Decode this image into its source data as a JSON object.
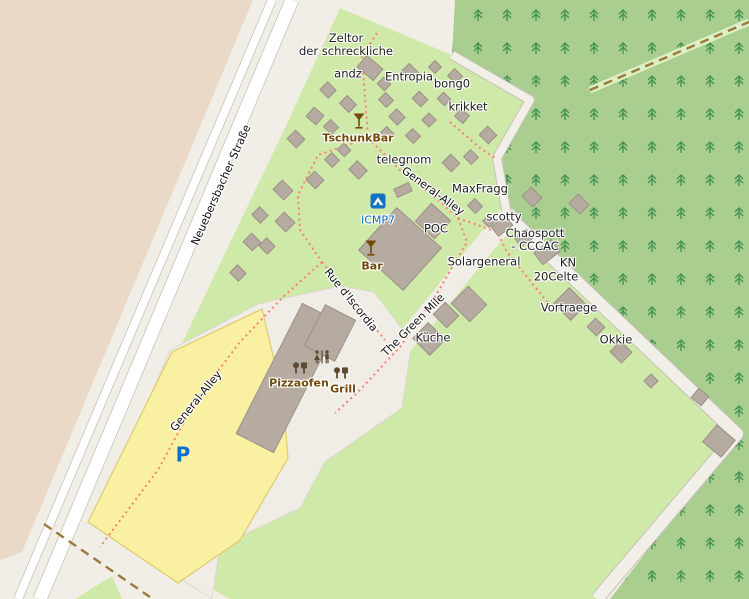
{
  "map": {
    "colors": {
      "bg": "#f1eee8",
      "tan": "#e9d9c6",
      "green": "#cfe9a8",
      "forest": "#aace8f",
      "tree": "#449552",
      "road_fill": "#ffffff",
      "road_casing": "#c6c2ba",
      "offwhite_road": "#f2efe9",
      "corridor": "#f0ede7",
      "corridor_stroke": "#dcd8d0",
      "yellow": "#faf0a2",
      "yellow_border": "#ddcb6e",
      "building": "#b5aba1",
      "building_stroke": "#9b9187",
      "path_dots": "#fa8072",
      "track": "#9c7a3a",
      "track_halo": "#dcefc5",
      "amenity_brown": "#734a08",
      "poi_icon_brown": "#5f4a33",
      "campsite_blue": "#1272bf",
      "parking_blue": "#0d6fd0"
    },
    "regions": {
      "tan": "0,0 253,0 22,552 0,560",
      "green_main": "340,8 452,55 530,100 497,158 507,215 737,434 597,599 230,599 95,525 285,128",
      "forest": "455,0 749,0 749,599 610,599 737,434 507,215 497,158 530,100 452,55",
      "corridor": "258,304 340,286 374,292 412,342 402,408 325,462 300,508 220,546 212,599 95,525 170,350",
      "yellow_parking": "262,309 283,398 288,458 240,540 178,583 88,522 172,352",
      "green_patch": "75,599 112,576 122,599"
    },
    "roads": {
      "greenmile_band": {
        "pts": [
          [
            507,
            218
          ],
          [
            470,
            262
          ],
          [
            425,
            318
          ],
          [
            378,
            372
          ],
          [
            340,
            412
          ]
        ],
        "w": 21
      },
      "forest_path": {
        "pts": [
          [
            452,
            55
          ],
          [
            530,
            100
          ],
          [
            497,
            158
          ],
          [
            507,
            215
          ]
        ],
        "w": 8
      },
      "forest_road": {
        "pts": [
          [
            507,
            215
          ],
          [
            737,
            434
          ],
          [
            597,
            599
          ]
        ],
        "w": 12
      },
      "main_road_small": {
        "pts": [
          [
            272,
            0
          ],
          [
            18,
            599
          ]
        ],
        "w": 8
      },
      "main_road_big": {
        "pts": [
          [
            292,
            0
          ],
          [
            40,
            599
          ]
        ],
        "w": 13
      }
    },
    "tracks": [
      {
        "pts": [
          [
            590,
            90
          ],
          [
            749,
            22
          ]
        ],
        "halo": true
      },
      {
        "pts": [
          [
            44,
            524
          ],
          [
            150,
            597
          ]
        ],
        "halo": false
      }
    ],
    "paths_dotted": [
      [
        [
          377,
          33
        ],
        [
          366,
          50
        ],
        [
          362,
          58
        ],
        [
          368,
          136
        ]
      ],
      [
        [
          368,
          138
        ],
        [
          318,
          155
        ],
        [
          298,
          195
        ],
        [
          300,
          230
        ],
        [
          322,
          262
        ]
      ],
      [
        [
          368,
          138
        ],
        [
          400,
          170
        ],
        [
          433,
          196
        ],
        [
          458,
          218
        ]
      ],
      [
        [
          458,
          218
        ],
        [
          497,
          232
        ],
        [
          507,
          252
        ],
        [
          548,
          303
        ]
      ],
      [
        [
          458,
          218
        ],
        [
          467,
          242
        ],
        [
          435,
          297
        ],
        [
          400,
          347
        ],
        [
          358,
          392
        ],
        [
          335,
          413
        ]
      ],
      [
        [
          322,
          262
        ],
        [
          352,
          300
        ],
        [
          385,
          340
        ]
      ],
      [
        [
          322,
          262
        ],
        [
          283,
          297
        ],
        [
          240,
          342
        ],
        [
          196,
          400
        ],
        [
          158,
          470
        ],
        [
          100,
          547
        ]
      ],
      [
        [
          450,
          122
        ],
        [
          480,
          148
        ],
        [
          495,
          158
        ]
      ]
    ],
    "buildings": [
      [
        370,
        68,
        21,
        15,
        40
      ],
      [
        328,
        90,
        12,
        11,
        45
      ],
      [
        348,
        104,
        13,
        11,
        45
      ],
      [
        315,
        116,
        13,
        12,
        40
      ],
      [
        331,
        127,
        11,
        10,
        45
      ],
      [
        296,
        139,
        13,
        12,
        45
      ],
      [
        384,
        84,
        10,
        9,
        45
      ],
      [
        410,
        72,
        13,
        11,
        45
      ],
      [
        435,
        67,
        9,
        9,
        45
      ],
      [
        455,
        76,
        11,
        10,
        45
      ],
      [
        386,
        100,
        11,
        10,
        45
      ],
      [
        420,
        99,
        12,
        10,
        45
      ],
      [
        444,
        99,
        10,
        9,
        45
      ],
      [
        397,
        117,
        12,
        11,
        45
      ],
      [
        429,
        120,
        10,
        10,
        45
      ],
      [
        462,
        116,
        11,
        10,
        40
      ],
      [
        387,
        134,
        11,
        10,
        45
      ],
      [
        413,
        136,
        11,
        10,
        45
      ],
      [
        488,
        135,
        13,
        12,
        45
      ],
      [
        344,
        150,
        10,
        9,
        45
      ],
      [
        332,
        160,
        11,
        10,
        45
      ],
      [
        358,
        170,
        14,
        12,
        45
      ],
      [
        283,
        190,
        15,
        13,
        45
      ],
      [
        315,
        180,
        13,
        12,
        45
      ],
      [
        260,
        215,
        12,
        11,
        45
      ],
      [
        285,
        222,
        15,
        13,
        45
      ],
      [
        252,
        242,
        13,
        12,
        45
      ],
      [
        267,
        246,
        12,
        11,
        45
      ],
      [
        238,
        273,
        12,
        11,
        45
      ],
      [
        451,
        163,
        13,
        12,
        45
      ],
      [
        471,
        157,
        11,
        10,
        45
      ],
      [
        403,
        190,
        16,
        9,
        -25
      ],
      [
        475,
        206,
        11,
        10,
        45
      ],
      [
        489,
        221,
        9,
        9,
        45
      ],
      [
        532,
        197,
        15,
        13,
        45
      ],
      [
        579,
        204,
        15,
        13,
        45
      ],
      [
        502,
        226,
        18,
        12,
        -38
      ],
      [
        524,
        238,
        15,
        11,
        -38
      ],
      [
        547,
        252,
        22,
        15,
        -38
      ],
      [
        400,
        249,
        60,
        57,
        42
      ],
      [
        433,
        221,
        26,
        24,
        42
      ],
      [
        469,
        304,
        26,
        24,
        45
      ],
      [
        446,
        315,
        19,
        17,
        45
      ],
      [
        429,
        339,
        24,
        22,
        45
      ],
      [
        570,
        304,
        24,
        22,
        45
      ],
      [
        596,
        327,
        13,
        12,
        45
      ],
      [
        621,
        352,
        16,
        15,
        45
      ],
      [
        651,
        381,
        10,
        10,
        45
      ],
      [
        700,
        397,
        13,
        12,
        40
      ],
      [
        719,
        441,
        24,
        22,
        40
      ],
      [
        288,
        378,
        42,
        146,
        27
      ],
      [
        330,
        333,
        34,
        46,
        27
      ]
    ],
    "street_labels": [
      {
        "text": "Neuebersbacher Straße",
        "x": 221,
        "y": 185,
        "rot": -66
      },
      {
        "text": "General-Alley",
        "x": 433,
        "y": 191,
        "rot": 36
      },
      {
        "text": "General-Alley",
        "x": 196,
        "y": 401,
        "rot": -51
      },
      {
        "text": "Rue d'Iscordia",
        "x": 351,
        "y": 300,
        "rot": 51
      },
      {
        "text": "The Green Mile",
        "x": 413,
        "y": 325,
        "rot": -45
      }
    ],
    "poi_labels": [
      {
        "text": "Zeltor\nder schreckliche",
        "x": 346,
        "y": 45,
        "type": "place"
      },
      {
        "text": "andz",
        "x": 348,
        "y": 74,
        "type": "place"
      },
      {
        "text": "Entropia",
        "x": 409,
        "y": 77,
        "type": "place"
      },
      {
        "text": "bong0",
        "x": 452,
        "y": 84,
        "type": "place"
      },
      {
        "text": "krikket",
        "x": 468,
        "y": 107,
        "type": "place"
      },
      {
        "text": "telegnom",
        "x": 404,
        "y": 160,
        "type": "place"
      },
      {
        "text": "MaxFragg",
        "x": 480,
        "y": 189,
        "type": "place"
      },
      {
        "text": "scotty",
        "x": 504,
        "y": 217,
        "type": "place"
      },
      {
        "text": "POC",
        "x": 436,
        "y": 229,
        "type": "place"
      },
      {
        "text": "Chaospott\n- CCCAC",
        "x": 535,
        "y": 240,
        "type": "place"
      },
      {
        "text": "Solargeneral",
        "x": 484,
        "y": 262,
        "type": "place"
      },
      {
        "text": "KN",
        "x": 568,
        "y": 263,
        "type": "place"
      },
      {
        "text": "20Celte",
        "x": 556,
        "y": 277,
        "type": "place"
      },
      {
        "text": "Vortraege",
        "x": 569,
        "y": 308,
        "type": "place"
      },
      {
        "text": "Okkie",
        "x": 616,
        "y": 340,
        "type": "place"
      },
      {
        "text": "Küche",
        "x": 433,
        "y": 338,
        "type": "place"
      },
      {
        "text": "TschunkBar",
        "x": 358,
        "y": 138,
        "type": "amenity"
      },
      {
        "text": "Bar",
        "x": 372,
        "y": 266,
        "type": "amenity"
      },
      {
        "text": "Pizzaofen",
        "x": 299,
        "y": 383,
        "type": "amenity"
      },
      {
        "text": "Grill",
        "x": 343,
        "y": 389,
        "type": "amenity"
      },
      {
        "text": "ICMP7",
        "x": 378,
        "y": 220,
        "type": "tourism"
      },
      {
        "text": "P",
        "x": 183,
        "y": 455,
        "type": "parking"
      }
    ],
    "icons": [
      {
        "name": "cocktail-icon",
        "x": 359,
        "y": 121
      },
      {
        "name": "cocktail-icon",
        "x": 371,
        "y": 248
      },
      {
        "name": "campsite-icon",
        "x": 378,
        "y": 201
      },
      {
        "name": "toilets-icon",
        "x": 322,
        "y": 357
      },
      {
        "name": "poi-round-icon",
        "x": 296,
        "y": 368
      },
      {
        "name": "poi-square-icon",
        "x": 304,
        "y": 368
      },
      {
        "name": "poi-round-icon",
        "x": 337,
        "y": 373
      },
      {
        "name": "poi-square-icon",
        "x": 345,
        "y": 373
      }
    ]
  }
}
